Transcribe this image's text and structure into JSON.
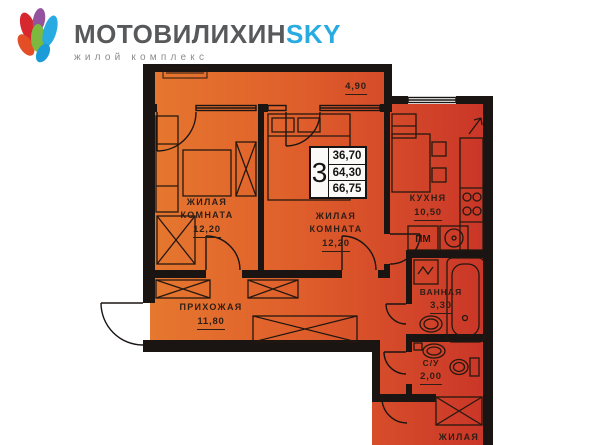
{
  "brand": {
    "name": "МОТОВИЛИХИН",
    "accent": "SKY",
    "subtitle": "жилой комплекс"
  },
  "stamp": {
    "rooms": "3",
    "values": [
      "36,70",
      "64,30",
      "66,75"
    ]
  },
  "plan": {
    "balcony_area": "4,90",
    "labels": [
      {
        "name": "ЖИЛАЯ КОМНАТА",
        "area": "12,20"
      },
      {
        "name": "ЖИЛАЯ КОМНАТА",
        "area": "12,20"
      },
      {
        "name": "КУХНЯ",
        "area": "10,50"
      },
      {
        "name": "ПРИХОЖАЯ",
        "area": "11,80"
      },
      {
        "name": "ВАННАЯ",
        "area": "3,30"
      },
      {
        "name": "С/У",
        "area": "2,00"
      },
      {
        "name": "ЖИЛАЯ",
        "area": ""
      }
    ],
    "appliance_labels": {
      "dishwasher": "ПМ"
    }
  },
  "colors": {
    "floor_left": "#E6792F",
    "floor_mid": "#DF5E2B",
    "floor_right": "#C93428",
    "wall": "#1A1512",
    "brand_gray": "#58595B",
    "brand_blue": "#29ABE2"
  }
}
